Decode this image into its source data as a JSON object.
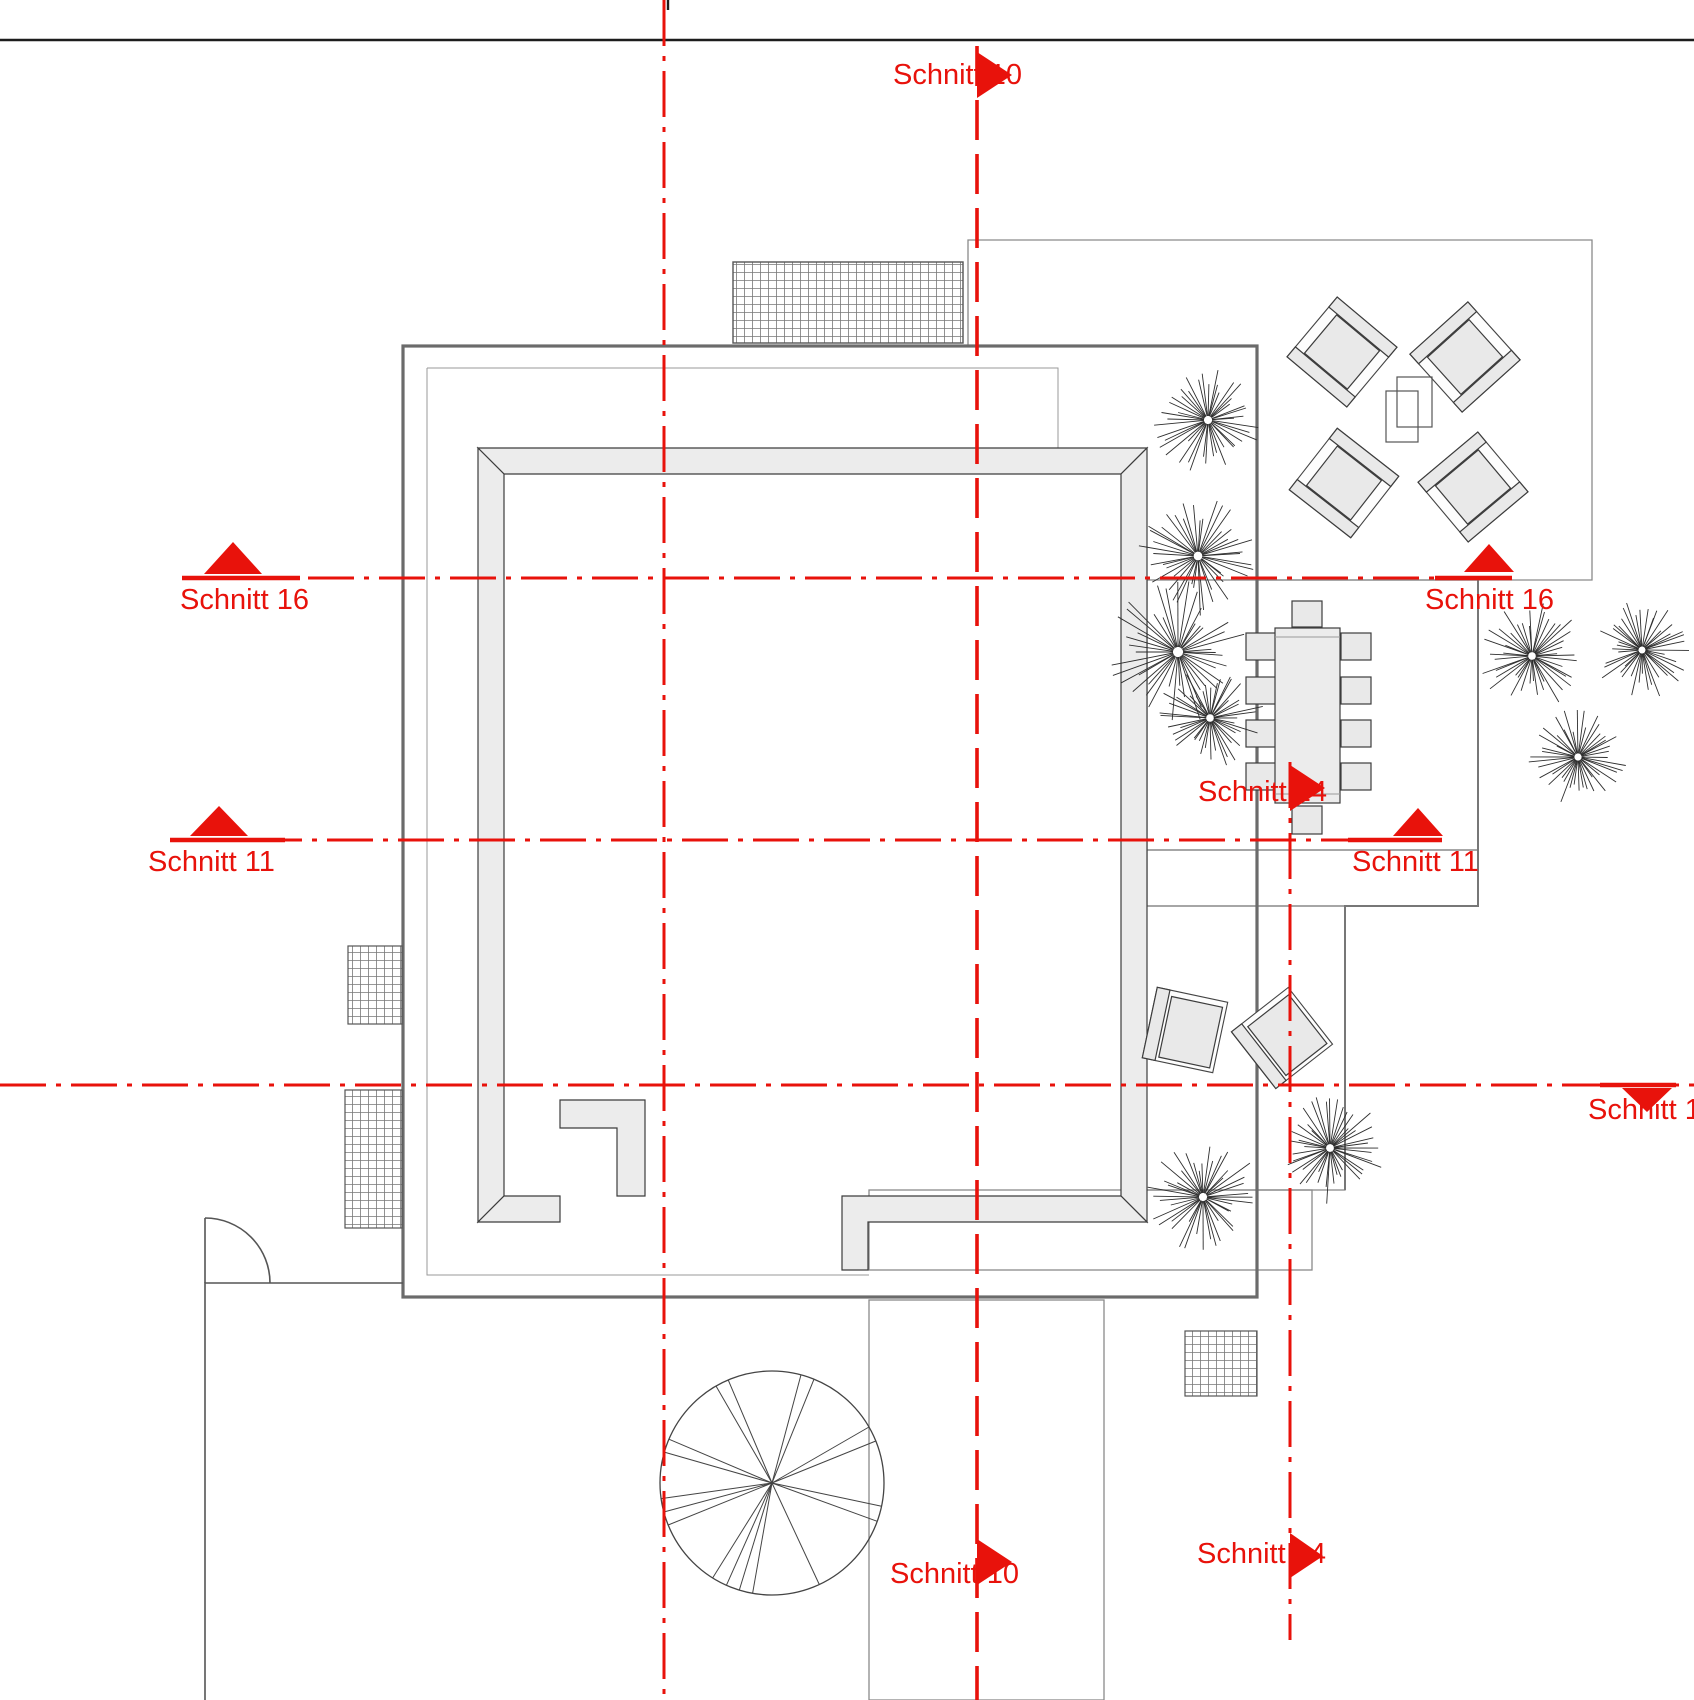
{
  "drawing": {
    "kind": "architectural roof terrace plan with section markers",
    "labels": {
      "schnitt_10": "Schnitt 10",
      "schnitt_11": "Schnitt 11",
      "schnitt_14": "Schnitt 14",
      "schnitt_16": "Schnitt 16",
      "schnitt_1": "Schnitt 1"
    },
    "colors": {
      "section_red": "#e8120b",
      "outline_dark": "#6b6b6b",
      "paving_joint": "#ababab",
      "parapet_fill": "#ececec",
      "furniture_fill": "#e9e9e9"
    },
    "trees": [
      {
        "cx": 1208,
        "cy": 420,
        "r": 58
      },
      {
        "cx": 1198,
        "cy": 556,
        "r": 62
      },
      {
        "cx": 1178,
        "cy": 652,
        "r": 72
      },
      {
        "cx": 1210,
        "cy": 718,
        "r": 55
      },
      {
        "cx": 1532,
        "cy": 656,
        "r": 55
      },
      {
        "cx": 1642,
        "cy": 650,
        "r": 50
      },
      {
        "cx": 1578,
        "cy": 757,
        "r": 52
      },
      {
        "cx": 1330,
        "cy": 1148,
        "r": 56
      },
      {
        "cx": 1203,
        "cy": 1197,
        "r": 58
      }
    ],
    "stair": {
      "cx": 772,
      "cy": 1483,
      "r": 112,
      "angles": [
        100,
        107,
        114,
        122,
        158,
        165,
        172,
        196,
        203,
        240,
        247,
        285,
        292,
        330,
        338,
        12,
        20,
        65
      ]
    }
  }
}
